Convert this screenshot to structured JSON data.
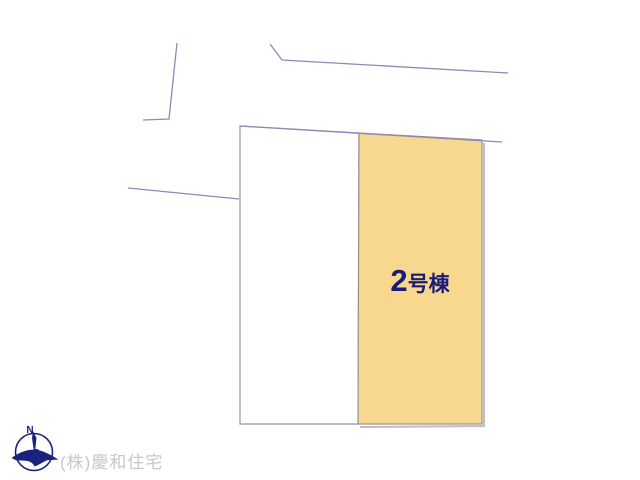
{
  "map": {
    "lot": {
      "number": "2",
      "suffix": "号棟",
      "full_label": "2号棟"
    },
    "colors": {
      "background": "#FFFFFF",
      "road_line": "#8B8BBB",
      "parcel_border": "#9494AE",
      "lot_fill": "#F8D78E",
      "lot_border": "#9A948C",
      "lot_shadow": "#BEBEBE",
      "label_text": "#1B1B78",
      "compass_navy": "#1C2180",
      "company_text": "#C8C8C8"
    }
  },
  "compass": {
    "north_label": "N"
  },
  "footer": {
    "company_name": "(株)慶和住宅"
  }
}
